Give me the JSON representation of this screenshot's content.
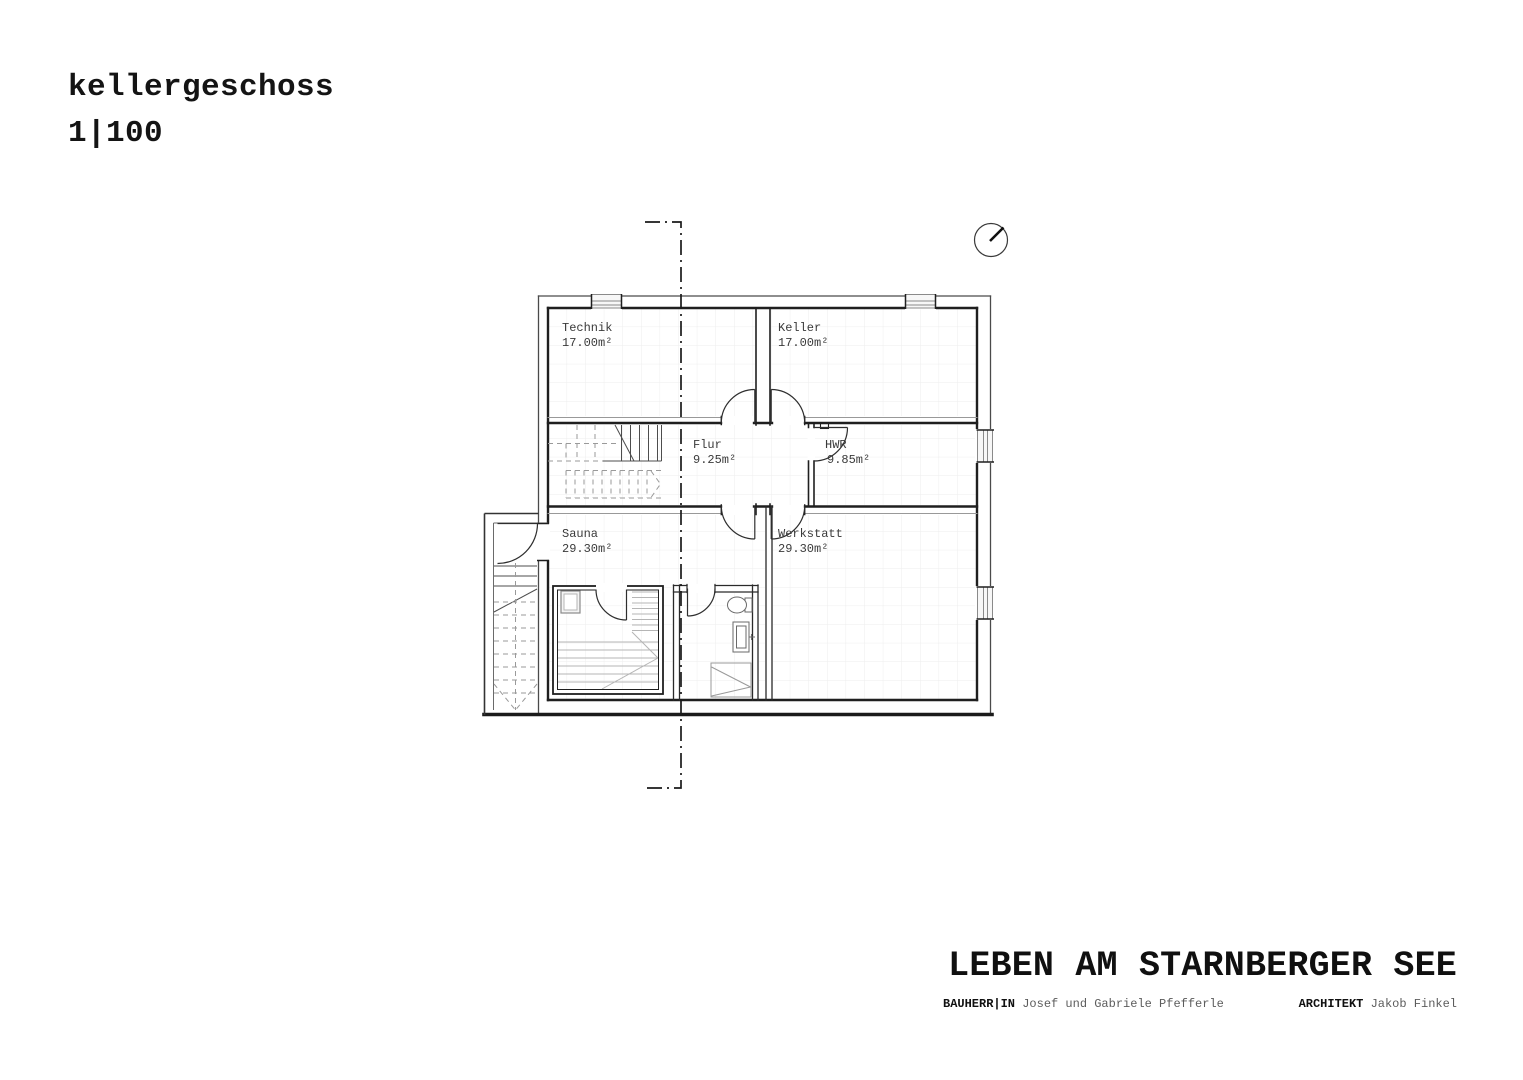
{
  "header": {
    "title": "kellergeschoss",
    "scale": "1|100"
  },
  "plan": {
    "rooms": [
      {
        "id": "technik",
        "name": "Technik",
        "area": "17.00m²"
      },
      {
        "id": "keller",
        "name": "Keller",
        "area": "17.00m²"
      },
      {
        "id": "flur",
        "name": "Flur",
        "area": "9.25m²"
      },
      {
        "id": "hwr",
        "name": "HWR",
        "area": "9.85m²"
      },
      {
        "id": "sauna",
        "name": "Sauna",
        "area": "29.30m²"
      },
      {
        "id": "werkstatt",
        "name": "Werkstatt",
        "area": "29.30m²"
      }
    ],
    "symbols": {
      "north_indicator": "compass-circle",
      "section_line": "dash-dot-cut-line"
    }
  },
  "title_block": {
    "project": "LEBEN AM STARNBERGER SEE",
    "client_label": "BAUHERR|IN",
    "client_name": "Josef und Gabriele Pfefferle",
    "architect_label": "ARCHITEKT",
    "architect_name": "Jakob Finkel"
  },
  "colors": {
    "ink": "#1f1f1f",
    "thin_line": "#8a8a8a",
    "grid": "#ededed",
    "label_text": "#3a3a3a",
    "muted_text": "#5c5c5c"
  }
}
